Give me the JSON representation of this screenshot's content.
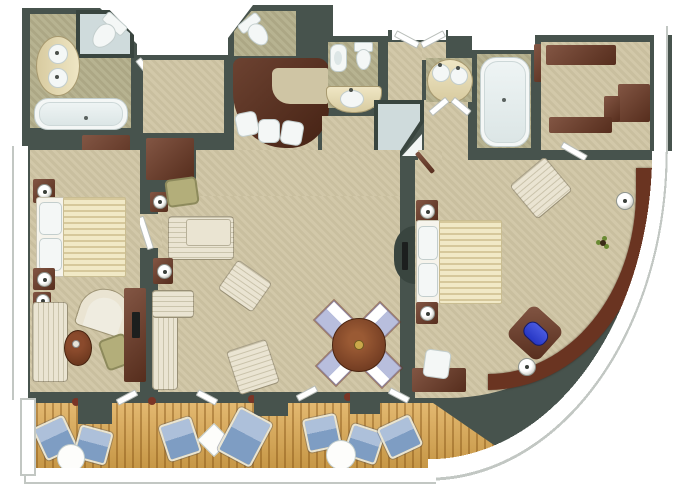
{
  "title": "suite-floor-plan",
  "palette": {
    "wall": "#47534d",
    "wallDark": "#39453f",
    "carpet": "#cfc5a4",
    "bathFloor": "#b3ae8a",
    "deck": "#dca74d",
    "wood": "#6e3a25",
    "woodBar": "#5c2d1a",
    "cream": "#eae4d2",
    "duvet": "#f1e9c6",
    "fixture": "#f4f7f6",
    "fixtureEdge": "#c3cecd",
    "glass": "#cfdbdc",
    "blue": "#7e9dc3",
    "blueLight": "#adc0da",
    "lavender": "#b8bedd",
    "chaiseBlue": "#2636c4",
    "olive": "#b3ae7a",
    "trim": "#c2c7c3",
    "plantRed": "#7a3526",
    "plantGreen": "#6a8a33",
    "tv": "#1c1f1e",
    "white": "#ffffff"
  },
  "floor_plan": {
    "type": "cruise-suite-floor-plan",
    "rooms": [
      {
        "name": "master-bathroom",
        "furniture": [
          "toilet",
          "double-sink-vanity",
          "corner-shower",
          "bathtub"
        ]
      },
      {
        "name": "dressing-corridor",
        "furniture": [
          "wardrobe",
          "wardrobe"
        ]
      },
      {
        "name": "master-bedroom",
        "furniture": [
          "king-bed",
          "nightstand-with-lamp",
          "nightstand-with-lamp",
          "sofa",
          "tub-chair",
          "coffee-table",
          "desk-chair",
          "vanity-desk-with-tv"
        ]
      },
      {
        "name": "powder-room",
        "furniture": [
          "toilet"
        ]
      },
      {
        "name": "bar",
        "furniture": [
          "bar-counter",
          "bar-stool",
          "bar-stool",
          "bar-stool"
        ]
      },
      {
        "name": "guest-bathroom",
        "furniture": [
          "bidet",
          "toilet",
          "sink-vanity",
          "corner-shower"
        ]
      },
      {
        "name": "entry-hall",
        "furniture": [
          "double-entry-door"
        ]
      },
      {
        "name": "second-bathroom",
        "furniture": [
          "double-sink-vanity",
          "bathtub",
          "cabinet"
        ]
      },
      {
        "name": "walk-in-closet",
        "furniture": [
          "wardrobe",
          "wardrobe",
          "wardrobe"
        ]
      },
      {
        "name": "living-dining-room",
        "furniture": [
          "sectional-sofa",
          "corner-sofa",
          "armchair",
          "armchair",
          "side-table-with-lamp",
          "side-table-with-lamp",
          "olive-chair",
          "dining-table",
          "dining-chair",
          "dining-chair",
          "dining-chair",
          "dining-chair",
          "tv-console"
        ]
      },
      {
        "name": "second-bedroom",
        "furniture": [
          "queen-bed",
          "nightstand-with-lamp",
          "nightstand-with-lamp",
          "armchair",
          "desk",
          "desk-chair",
          "curved-console",
          "table-lamp",
          "table-lamp",
          "potted-plant",
          "chaise-with-blue-cushion"
        ]
      },
      {
        "name": "veranda",
        "furniture": [
          "lounge-chair",
          "lounge-chair",
          "lounge-chair",
          "lounge-chair",
          "lounge-chair",
          "lounge-chair",
          "deck-lounger",
          "round-table",
          "round-table",
          "square-table",
          "privacy-partition",
          "privacy-partition",
          "privacy-partition"
        ]
      }
    ]
  }
}
